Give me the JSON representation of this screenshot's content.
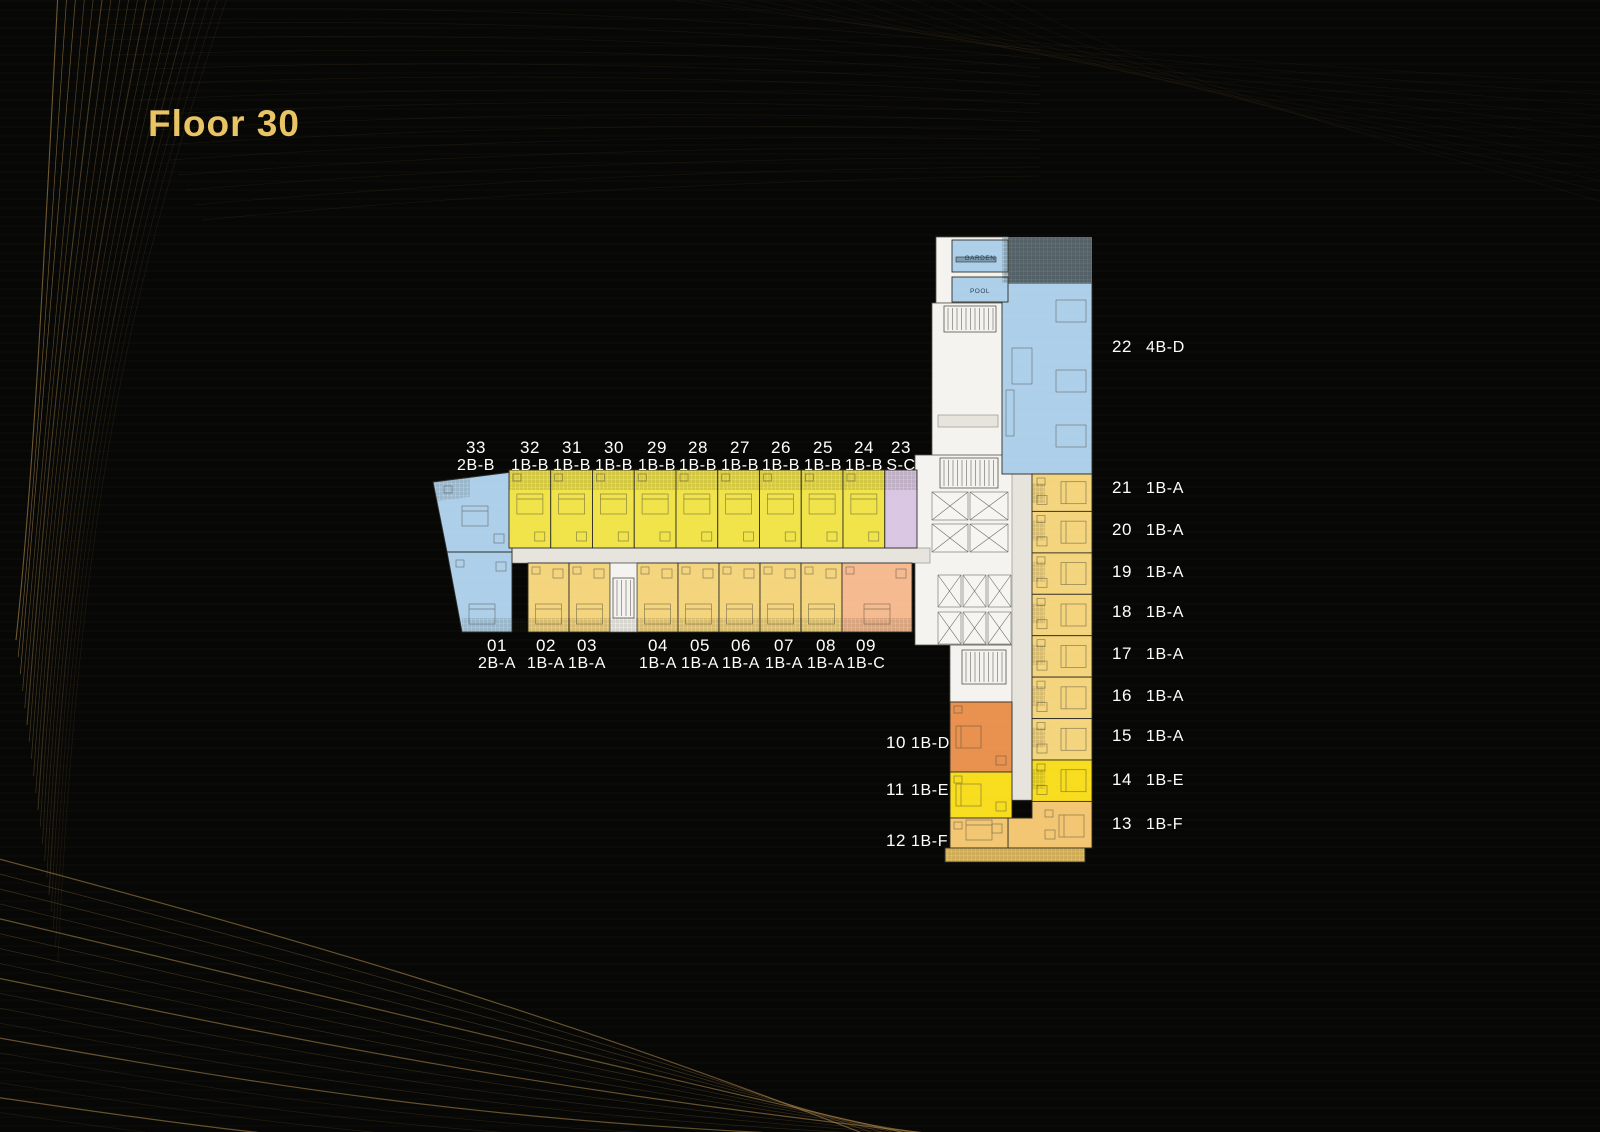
{
  "title": "Floor 30",
  "colors": {
    "background": "#070705",
    "title_gold": "#e9c464",
    "decor_gold": "#c89c55",
    "label_text": "#ffffff",
    "corridor": "#e6e4dd",
    "unit_type_colors": {
      "1B-A": "#f4d57e",
      "1B-B": "#f1e34a",
      "1B-C": "#f5ba90",
      "1B-D": "#e9914f",
      "1B-E": "#f8dd1f",
      "1B-F": "#f2c672",
      "2B-A": "#aecfe9",
      "2B-B": "#aecfe9",
      "4B-D": "#aecfe9",
      "S-C": "#d9c6e3"
    }
  },
  "plan": {
    "garden_label": "GARDEN",
    "pool_label": "POOL",
    "top_row_units": [
      {
        "number": "33",
        "type": "2B-B"
      },
      {
        "number": "32",
        "type": "1B-B"
      },
      {
        "number": "31",
        "type": "1B-B"
      },
      {
        "number": "30",
        "type": "1B-B"
      },
      {
        "number": "29",
        "type": "1B-B"
      },
      {
        "number": "28",
        "type": "1B-B"
      },
      {
        "number": "27",
        "type": "1B-B"
      },
      {
        "number": "26",
        "type": "1B-B"
      },
      {
        "number": "25",
        "type": "1B-B"
      },
      {
        "number": "24",
        "type": "1B-B"
      },
      {
        "number": "23",
        "type": "S-C"
      }
    ],
    "bottom_row_units": [
      {
        "number": "01",
        "type": "2B-A"
      },
      {
        "number": "02",
        "type": "1B-A"
      },
      {
        "number": "03",
        "type": "1B-A"
      },
      {
        "number": "04",
        "type": "1B-A"
      },
      {
        "number": "05",
        "type": "1B-A"
      },
      {
        "number": "06",
        "type": "1B-A"
      },
      {
        "number": "07",
        "type": "1B-A"
      },
      {
        "number": "08",
        "type": "1B-A"
      },
      {
        "number": "09",
        "type": "1B-C"
      }
    ],
    "right_column_units": [
      {
        "number": "22",
        "type": "4B-D"
      },
      {
        "number": "21",
        "type": "1B-A"
      },
      {
        "number": "20",
        "type": "1B-A"
      },
      {
        "number": "19",
        "type": "1B-A"
      },
      {
        "number": "18",
        "type": "1B-A"
      },
      {
        "number": "17",
        "type": "1B-A"
      },
      {
        "number": "16",
        "type": "1B-A"
      },
      {
        "number": "15",
        "type": "1B-A"
      },
      {
        "number": "14",
        "type": "1B-E"
      },
      {
        "number": "13",
        "type": "1B-F"
      }
    ],
    "left_column_units": [
      {
        "number": "10",
        "type": "1B-D"
      },
      {
        "number": "11",
        "type": "1B-E"
      },
      {
        "number": "12",
        "type": "1B-F"
      }
    ]
  }
}
